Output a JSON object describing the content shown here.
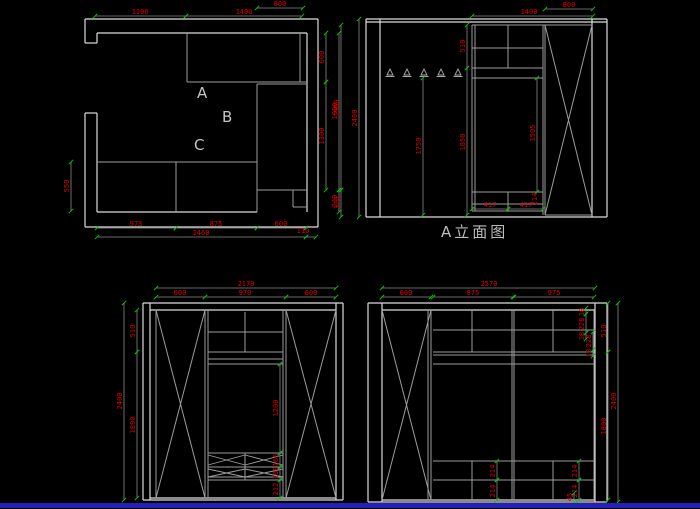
{
  "canvas": {
    "width": 700,
    "height": 509,
    "background": "#000000",
    "bottom_bar_color": "#2222bb",
    "bottom_bar_y": 503,
    "bottom_bar_height": 5
  },
  "colors": {
    "wall_line": "#dcdcdc",
    "cabinet_line": "#9c9c9c",
    "dim_line": "#8a8a8a",
    "dim_text": "#e00000",
    "tick": "#00c800",
    "label_text": "#bdbdbd"
  },
  "texts": {
    "elevation_a_title": {
      "text": "A立面图"
    },
    "plan_room_labels": [
      {
        "text": "A"
      },
      {
        "text": "B"
      },
      {
        "text": "C"
      }
    ]
  },
  "hooks": {
    "y": 69,
    "xs": [
      390,
      407,
      424,
      441,
      458
    ]
  },
  "geometry": {
    "groups": [
      {
        "name": "wall-line",
        "color": "#dcdcdc",
        "width": 1.2,
        "lines": [
          [
            85,
            19,
            318,
            19
          ],
          [
            318,
            19,
            318,
            227
          ],
          [
            85,
            227,
            318,
            227
          ],
          [
            85,
            19,
            85,
            43
          ],
          [
            85,
            43,
            97,
            43
          ],
          [
            97,
            33,
            97,
            43
          ],
          [
            97,
            33,
            307,
            33
          ],
          [
            307,
            33,
            307,
            212
          ],
          [
            85,
            113,
            97,
            113
          ],
          [
            85,
            113,
            85,
            227
          ],
          [
            97,
            113,
            97,
            212
          ],
          [
            97,
            212,
            257,
            212
          ],
          [
            366,
            19,
            607,
            19
          ],
          [
            366,
            22,
            607,
            22
          ],
          [
            366,
            19,
            366,
            217
          ],
          [
            380,
            19,
            380,
            217
          ],
          [
            592,
            19,
            592,
            217
          ],
          [
            607,
            19,
            607,
            217
          ],
          [
            366,
            217,
            607,
            217
          ],
          [
            143,
            303,
            343,
            303
          ],
          [
            143,
            303,
            143,
            500
          ],
          [
            150,
            303,
            150,
            500
          ],
          [
            336,
            303,
            336,
            500
          ],
          [
            343,
            303,
            343,
            500
          ],
          [
            143,
            500,
            343,
            500
          ],
          [
            150,
            310,
            336,
            310
          ],
          [
            150,
            498,
            336,
            498
          ],
          [
            368,
            303,
            607,
            303
          ],
          [
            368,
            303,
            368,
            502
          ],
          [
            382,
            303,
            382,
            502
          ],
          [
            595,
            303,
            595,
            502
          ],
          [
            607,
            303,
            607,
            502
          ],
          [
            368,
            502,
            607,
            502
          ],
          [
            382,
            310,
            595,
            310
          ],
          [
            382,
            500,
            595,
            500
          ]
        ]
      },
      {
        "name": "cabinet-line",
        "color": "#9c9c9c",
        "width": 1,
        "lines": [
          [
            187,
            33,
            187,
            82
          ],
          [
            187,
            82,
            307,
            82
          ],
          [
            300,
            33,
            300,
            82
          ],
          [
            257,
            84,
            307,
            84
          ],
          [
            257,
            84,
            257,
            190
          ],
          [
            257,
            190,
            307,
            190
          ],
          [
            97,
            162,
            257,
            162
          ],
          [
            176,
            162,
            176,
            212
          ],
          [
            257,
            162,
            257,
            212
          ],
          [
            293,
            190,
            293,
            207
          ],
          [
            293,
            207,
            307,
            207
          ],
          [
            472,
            25,
            592,
            25
          ],
          [
            472,
            25,
            472,
            211
          ],
          [
            475,
            25,
            475,
            211
          ],
          [
            508,
            25,
            508,
            68
          ],
          [
            472,
            48,
            543,
            48
          ],
          [
            472,
            68,
            543,
            68
          ],
          [
            472,
            78,
            543,
            78
          ],
          [
            472,
            192,
            543,
            192
          ],
          [
            508,
            192,
            508,
            211
          ],
          [
            472,
            204,
            543,
            204
          ],
          [
            472,
            211,
            543,
            211
          ],
          [
            543,
            25,
            543,
            215
          ],
          [
            545,
            25,
            545,
            215
          ],
          [
            545,
            215,
            592,
            215
          ],
          [
            156,
            310,
            156,
            498
          ],
          [
            205,
            310,
            205,
            498
          ],
          [
            208,
            310,
            208,
            498
          ],
          [
            283,
            310,
            283,
            498
          ],
          [
            286,
            310,
            286,
            498
          ],
          [
            208,
            332,
            283,
            332
          ],
          [
            208,
            352,
            283,
            352
          ],
          [
            208,
            359,
            283,
            359
          ],
          [
            208,
            364,
            283,
            364
          ],
          [
            245,
            312,
            245,
            352
          ],
          [
            208,
            453,
            283,
            453
          ],
          [
            208,
            467,
            283,
            467
          ],
          [
            208,
            477,
            283,
            477
          ],
          [
            208,
            480,
            283,
            480
          ],
          [
            245,
            453,
            245,
            480
          ],
          [
            428,
            310,
            428,
            500
          ],
          [
            431,
            310,
            431,
            500
          ],
          [
            512,
            310,
            512,
            500
          ],
          [
            514,
            310,
            514,
            500
          ],
          [
            594,
            310,
            594,
            500
          ],
          [
            433,
            330,
            594,
            330
          ],
          [
            433,
            352,
            594,
            352
          ],
          [
            433,
            355,
            594,
            355
          ],
          [
            433,
            364,
            594,
            364
          ],
          [
            472,
            310,
            472,
            352
          ],
          [
            553,
            310,
            553,
            352
          ],
          [
            433,
            461,
            594,
            461
          ],
          [
            433,
            480,
            594,
            480
          ],
          [
            472,
            461,
            472,
            500
          ],
          [
            553,
            461,
            553,
            500
          ]
        ]
      },
      {
        "name": "door-cross-line",
        "color": "#9c9c9c",
        "width": 1,
        "lines": [
          [
            545,
            25,
            592,
            215
          ],
          [
            592,
            25,
            545,
            215
          ],
          [
            156,
            310,
            205,
            498
          ],
          [
            205,
            310,
            156,
            498
          ],
          [
            286,
            310,
            336,
            498
          ],
          [
            336,
            310,
            286,
            498
          ],
          [
            382,
            310,
            431,
            500
          ],
          [
            431,
            310,
            382,
            500
          ]
        ]
      },
      {
        "name": "shoe-rack-zigzag-line",
        "color": "#9c9c9c",
        "width": 0.9,
        "lines": [
          [
            208,
            455,
            245,
            465
          ],
          [
            208,
            465,
            245,
            455
          ],
          [
            245,
            455,
            283,
            465
          ],
          [
            245,
            465,
            283,
            455
          ],
          [
            208,
            469,
            245,
            477
          ],
          [
            208,
            477,
            245,
            469
          ],
          [
            245,
            469,
            283,
            477
          ],
          [
            245,
            477,
            283,
            469
          ]
        ]
      }
    ]
  },
  "dimensions": [
    {
      "text": "800",
      "rot": 0,
      "tx": 280,
      "ty": 6,
      "line": [
        257,
        8,
        303,
        8
      ]
    },
    {
      "text": "1100",
      "rot": 0,
      "tx": 140,
      "ty": 14,
      "line": [
        95,
        16,
        186,
        16
      ]
    },
    {
      "text": "1400",
      "rot": 0,
      "tx": 244,
      "ty": 14,
      "line": [
        186,
        16,
        302,
        16
      ]
    },
    {
      "text": "600",
      "rot": -90,
      "tx": 324,
      "ty": 57,
      "line": [
        326,
        33,
        326,
        82
      ]
    },
    {
      "text": "1300",
      "rot": -90,
      "tx": 324,
      "ty": 136,
      "line": [
        326,
        82,
        326,
        190
      ]
    },
    {
      "text": "1900",
      "rot": -90,
      "tx": 337,
      "ty": 111,
      "line": [
        339,
        33,
        339,
        190
      ]
    },
    {
      "text": "230",
      "rot": -90,
      "tx": 337,
      "ty": 201,
      "line": [
        339,
        190,
        339,
        212
      ]
    },
    {
      "text": "550",
      "rot": -90,
      "tx": 69,
      "ty": 186,
      "line": [
        71,
        162,
        71,
        211
      ]
    },
    {
      "text": "973",
      "rot": 0,
      "tx": 136,
      "ty": 226,
      "line": [
        97,
        228,
        176,
        228
      ]
    },
    {
      "text": "875",
      "rot": 0,
      "tx": 216,
      "ty": 226,
      "line": [
        176,
        228,
        257,
        228
      ]
    },
    {
      "text": "600",
      "rot": 0,
      "tx": 281,
      "ty": 226,
      "line": [
        257,
        228,
        306,
        228
      ]
    },
    {
      "text": "2460",
      "rot": 0,
      "tx": 201,
      "ty": 235,
      "line": [
        97,
        237,
        306,
        237
      ]
    },
    {
      "text": "110",
      "rot": 0,
      "tx": 303,
      "ty": 233,
      "line": [
        306,
        237,
        316,
        237
      ]
    },
    {
      "text": "800",
      "rot": 0,
      "tx": 569,
      "ty": 7,
      "line": [
        545,
        9,
        593,
        9
      ]
    },
    {
      "text": "1400",
      "rot": 0,
      "tx": 529,
      "ty": 14,
      "line": [
        472,
        16,
        593,
        16
      ]
    },
    {
      "text": "510",
      "rot": -90,
      "tx": 465,
      "ty": 46,
      "line": [
        467,
        25,
        467,
        68
      ]
    },
    {
      "text": "1850",
      "rot": -90,
      "tx": 465,
      "ty": 142,
      "line": [
        467,
        68,
        467,
        215
      ]
    },
    {
      "text": "1750",
      "rot": -90,
      "tx": 421,
      "ty": 146,
      "line": [
        423,
        78,
        423,
        215
      ]
    },
    {
      "text": "1505",
      "rot": -90,
      "tx": 535,
      "ty": 133,
      "line": [
        537,
        78,
        537,
        192
      ]
    },
    {
      "text": "1900",
      "rot": -90,
      "tx": 339,
      "ty": 108,
      "line": [
        341,
        25,
        341,
        190
      ]
    },
    {
      "text": "320",
      "rot": -90,
      "tx": 339,
      "ty": 203,
      "line": [
        341,
        190,
        341,
        217
      ]
    },
    {
      "text": "2400",
      "rot": -90,
      "tx": 357,
      "ty": 118,
      "line": [
        359,
        19,
        359,
        217
      ]
    },
    {
      "text": "417",
      "rot": 0,
      "tx": 490,
      "ty": 207,
      "line": [
        472,
        209,
        508,
        209
      ]
    },
    {
      "text": "417",
      "rot": 0,
      "tx": 526,
      "ty": 207,
      "line": [
        508,
        209,
        543,
        209
      ]
    },
    {
      "text": "214",
      "rot": -90,
      "tx": 537,
      "ty": 199,
      "line": null
    },
    {
      "text": "2170",
      "rot": 0,
      "tx": 246,
      "ty": 286,
      "line": [
        156,
        288,
        336,
        288
      ]
    },
    {
      "text": "600",
      "rot": 0,
      "tx": 180,
      "ty": 295,
      "line": [
        156,
        297,
        205,
        297
      ]
    },
    {
      "text": "970",
      "rot": 0,
      "tx": 245,
      "ty": 295,
      "line": [
        205,
        297,
        286,
        297
      ]
    },
    {
      "text": "600",
      "rot": 0,
      "tx": 311,
      "ty": 295,
      "line": [
        286,
        297,
        336,
        297
      ]
    },
    {
      "text": "510",
      "rot": -90,
      "tx": 135,
      "ty": 331,
      "line": [
        137,
        310,
        137,
        352
      ]
    },
    {
      "text": "1890",
      "rot": -90,
      "tx": 135,
      "ty": 425,
      "line": [
        137,
        352,
        137,
        498
      ]
    },
    {
      "text": "2400",
      "rot": -90,
      "tx": 122,
      "ty": 401,
      "line": [
        124,
        303,
        124,
        500
      ]
    },
    {
      "text": "1200",
      "rot": -90,
      "tx": 278,
      "ty": 408,
      "line": [
        280,
        364,
        280,
        453
      ]
    },
    {
      "text": "165",
      "rot": -90,
      "tx": 278,
      "ty": 460,
      "line": [
        280,
        453,
        280,
        467
      ]
    },
    {
      "text": "160",
      "rot": -90,
      "tx": 278,
      "ty": 473,
      "line": [
        280,
        467,
        280,
        480
      ]
    },
    {
      "text": "212",
      "rot": -90,
      "tx": 278,
      "ty": 489,
      "line": [
        280,
        480,
        280,
        498
      ]
    },
    {
      "text": "2570",
      "rot": 0,
      "tx": 489,
      "ty": 286,
      "line": [
        382,
        288,
        595,
        288
      ]
    },
    {
      "text": "600",
      "rot": 0,
      "tx": 406,
      "ty": 295,
      "line": [
        382,
        297,
        431,
        297
      ]
    },
    {
      "text": "875",
      "rot": 0,
      "tx": 473,
      "ty": 295,
      "line": [
        433,
        297,
        513,
        297
      ]
    },
    {
      "text": "975",
      "rot": 0,
      "tx": 554,
      "ty": 295,
      "line": [
        514,
        297,
        594,
        297
      ]
    },
    {
      "text": "510",
      "rot": -90,
      "tx": 606,
      "ty": 331,
      "line": [
        608,
        303,
        608,
        352
      ]
    },
    {
      "text": "1800",
      "rot": -90,
      "tx": 606,
      "ty": 426,
      "line": [
        608,
        352,
        608,
        500
      ]
    },
    {
      "text": "2400",
      "rot": -90,
      "tx": 616,
      "ty": 401,
      "line": [
        618,
        303,
        618,
        502
      ]
    },
    {
      "text": "18",
      "rot": -90,
      "tx": 584,
      "ty": 312,
      "line": [
        586,
        308,
        586,
        314
      ]
    },
    {
      "text": "228",
      "rot": -90,
      "tx": 584,
      "ty": 324,
      "line": [
        586,
        314,
        586,
        333
      ]
    },
    {
      "text": "18",
      "rot": -90,
      "tx": 584,
      "ty": 336,
      "line": [
        586,
        333,
        586,
        339
      ]
    },
    {
      "text": "228",
      "rot": -90,
      "tx": 591,
      "ty": 341,
      "line": [
        593,
        332,
        593,
        350
      ]
    },
    {
      "text": "18",
      "rot": -90,
      "tx": 591,
      "ty": 353,
      "line": [
        593,
        350,
        593,
        356
      ]
    },
    {
      "text": "214",
      "rot": -90,
      "tx": 495,
      "ty": 471,
      "line": [
        497,
        461,
        497,
        480
      ]
    },
    {
      "text": "214",
      "rot": -90,
      "tx": 495,
      "ty": 491,
      "line": [
        497,
        480,
        497,
        500
      ]
    },
    {
      "text": "214",
      "rot": -90,
      "tx": 577,
      "ty": 471,
      "line": [
        579,
        461,
        579,
        480
      ]
    },
    {
      "text": "214",
      "rot": -90,
      "tx": 577,
      "ty": 491,
      "line": [
        579,
        480,
        579,
        500
      ]
    },
    {
      "text": "45",
      "rot": -90,
      "tx": 572,
      "ty": 497,
      "line": [
        574,
        493,
        574,
        502
      ]
    }
  ]
}
